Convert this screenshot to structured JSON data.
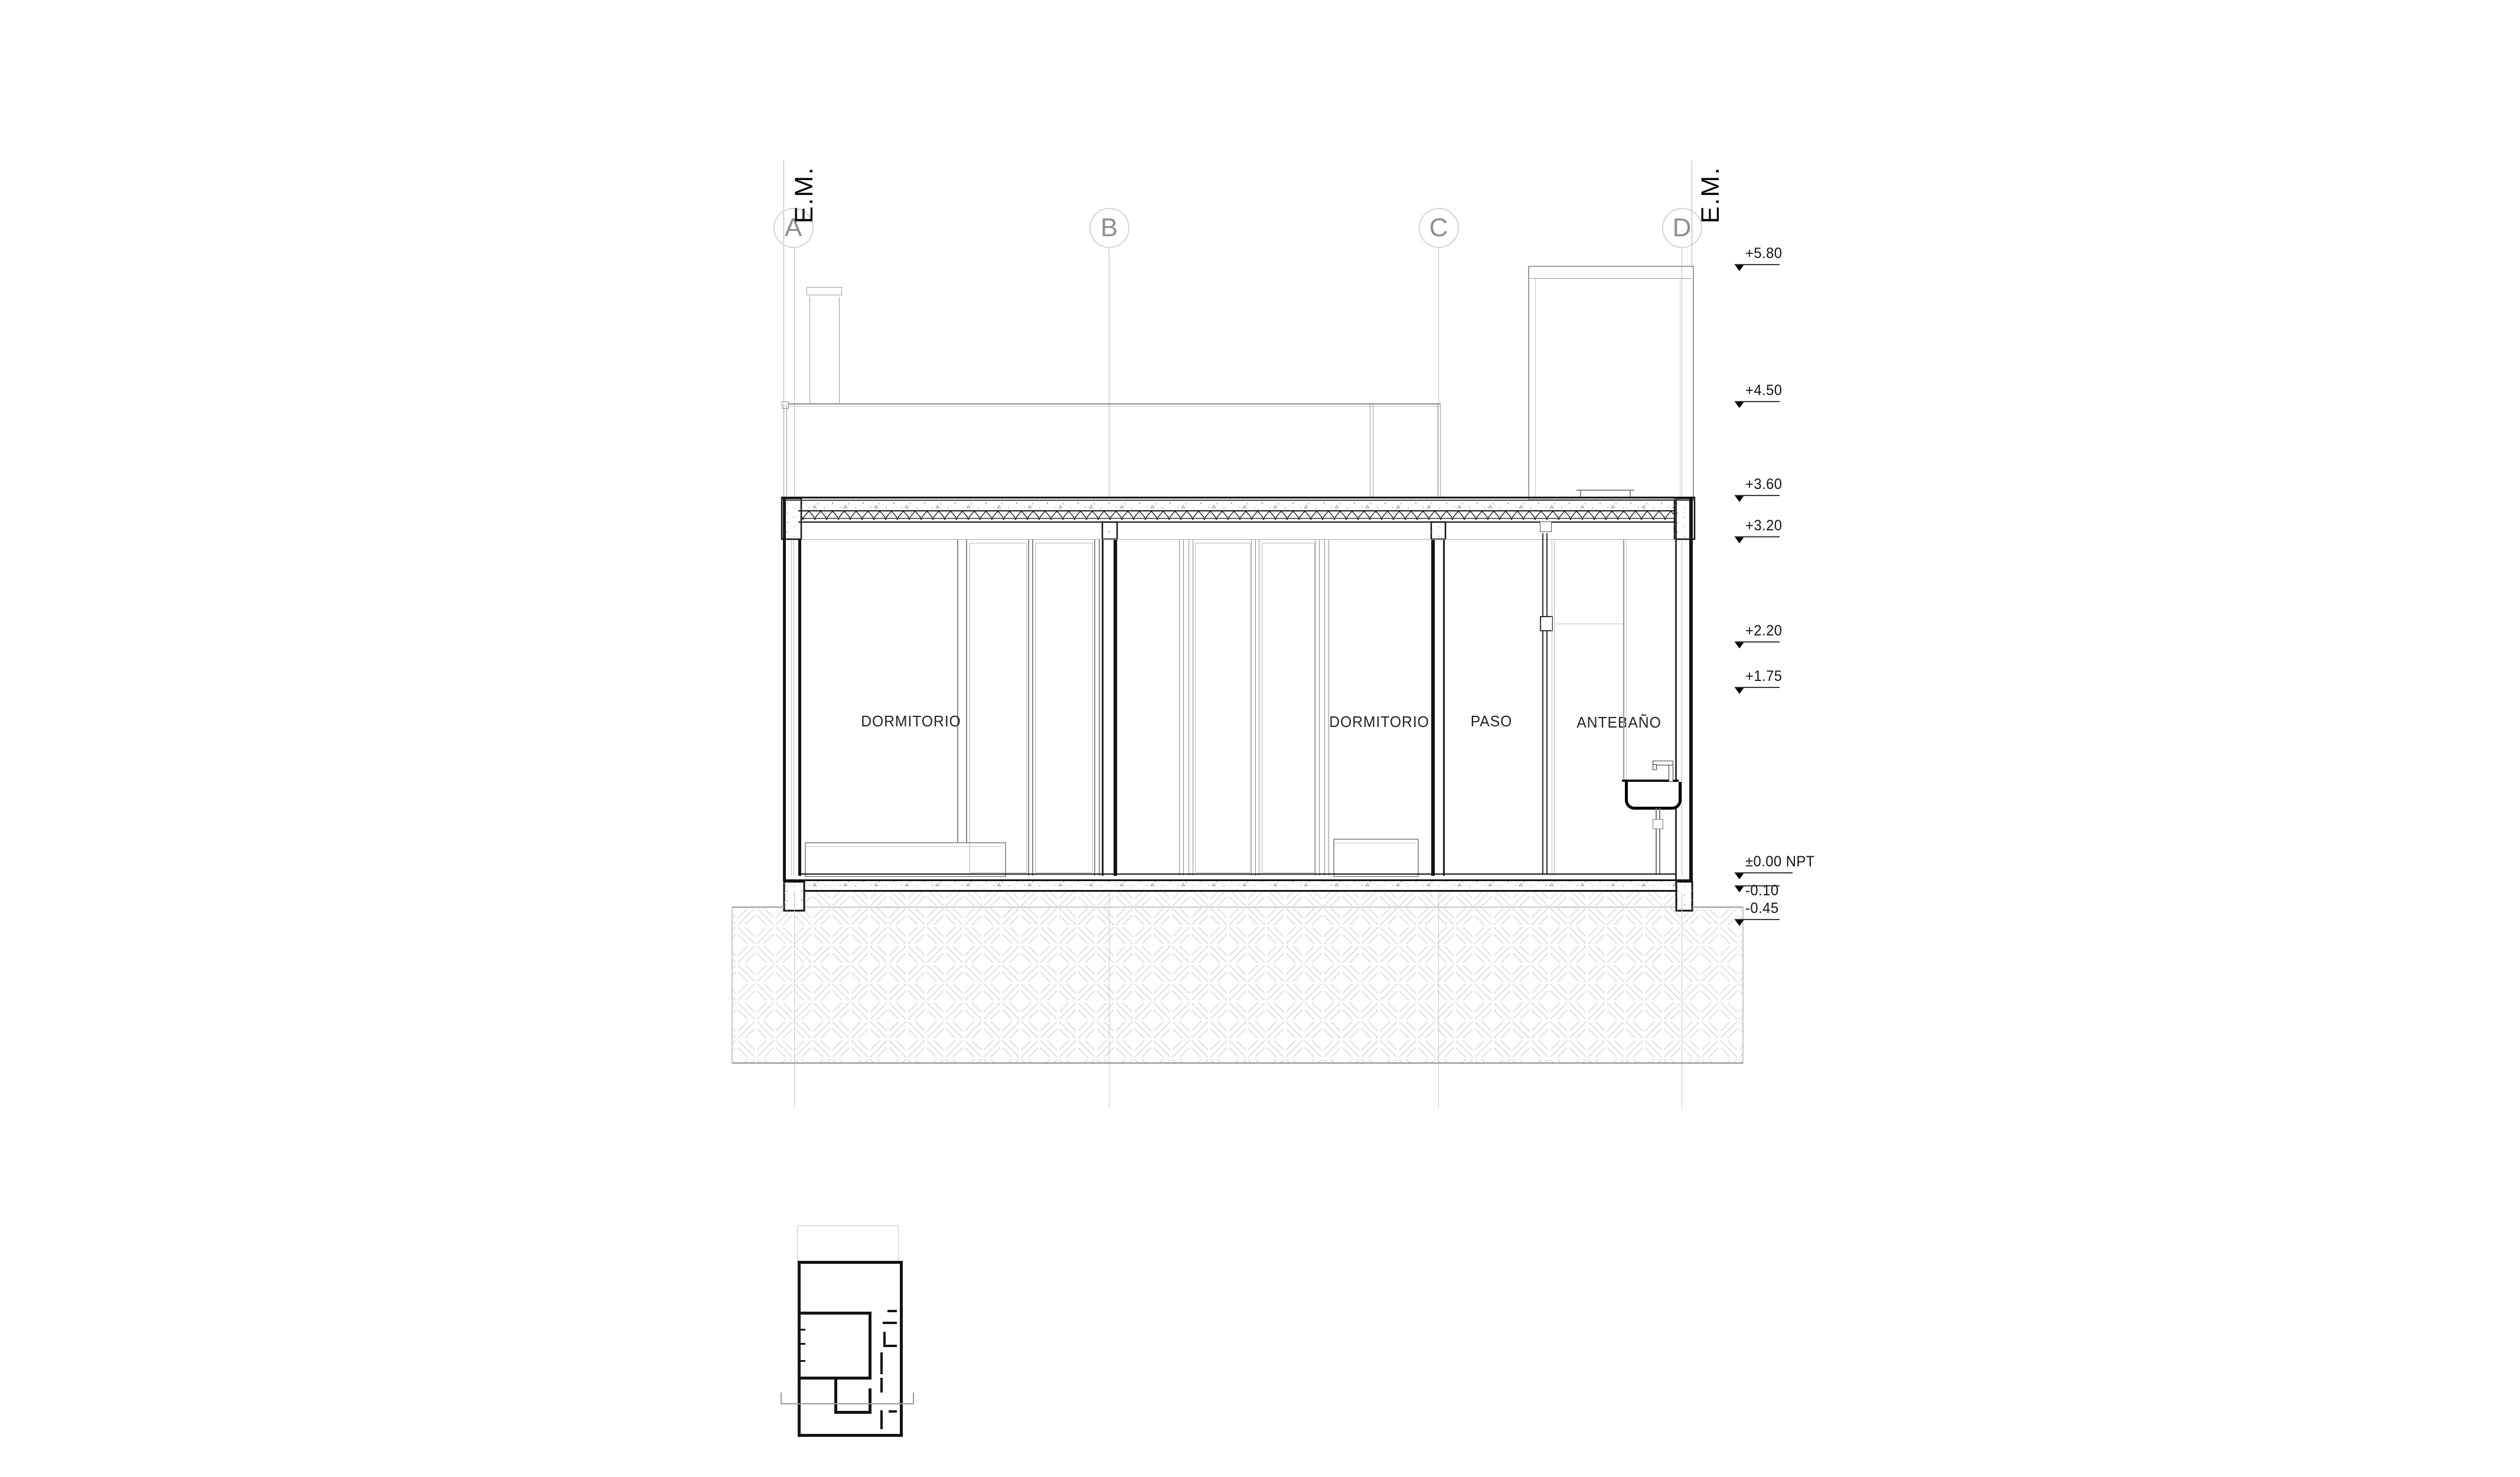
{
  "grid": {
    "axes": [
      {
        "label": "A"
      },
      {
        "label": "B"
      },
      {
        "label": "C"
      },
      {
        "label": "D"
      }
    ],
    "em": {
      "label": "E.M."
    }
  },
  "rooms": [
    {
      "label": "DORMITORIO"
    },
    {
      "label": "DORMITORIO"
    },
    {
      "label": "PASO"
    },
    {
      "label": "ANTEBAÑO"
    }
  ],
  "levels": [
    {
      "label": "+5.80"
    },
    {
      "label": "+4.50"
    },
    {
      "label": "+3.60"
    },
    {
      "label": "+3.20"
    },
    {
      "label": "+2.20"
    },
    {
      "label": "+1.75"
    },
    {
      "label": "±0.00 NPT"
    },
    {
      "label": "-0.10"
    },
    {
      "label": "-0.45"
    }
  ],
  "colors": {
    "line_black": "#141414",
    "line_gray": "#9a9a9a",
    "line_light": "#c9cdd2",
    "bubble_text": "#8f8f8f",
    "hatch": "#cbd0d6"
  }
}
